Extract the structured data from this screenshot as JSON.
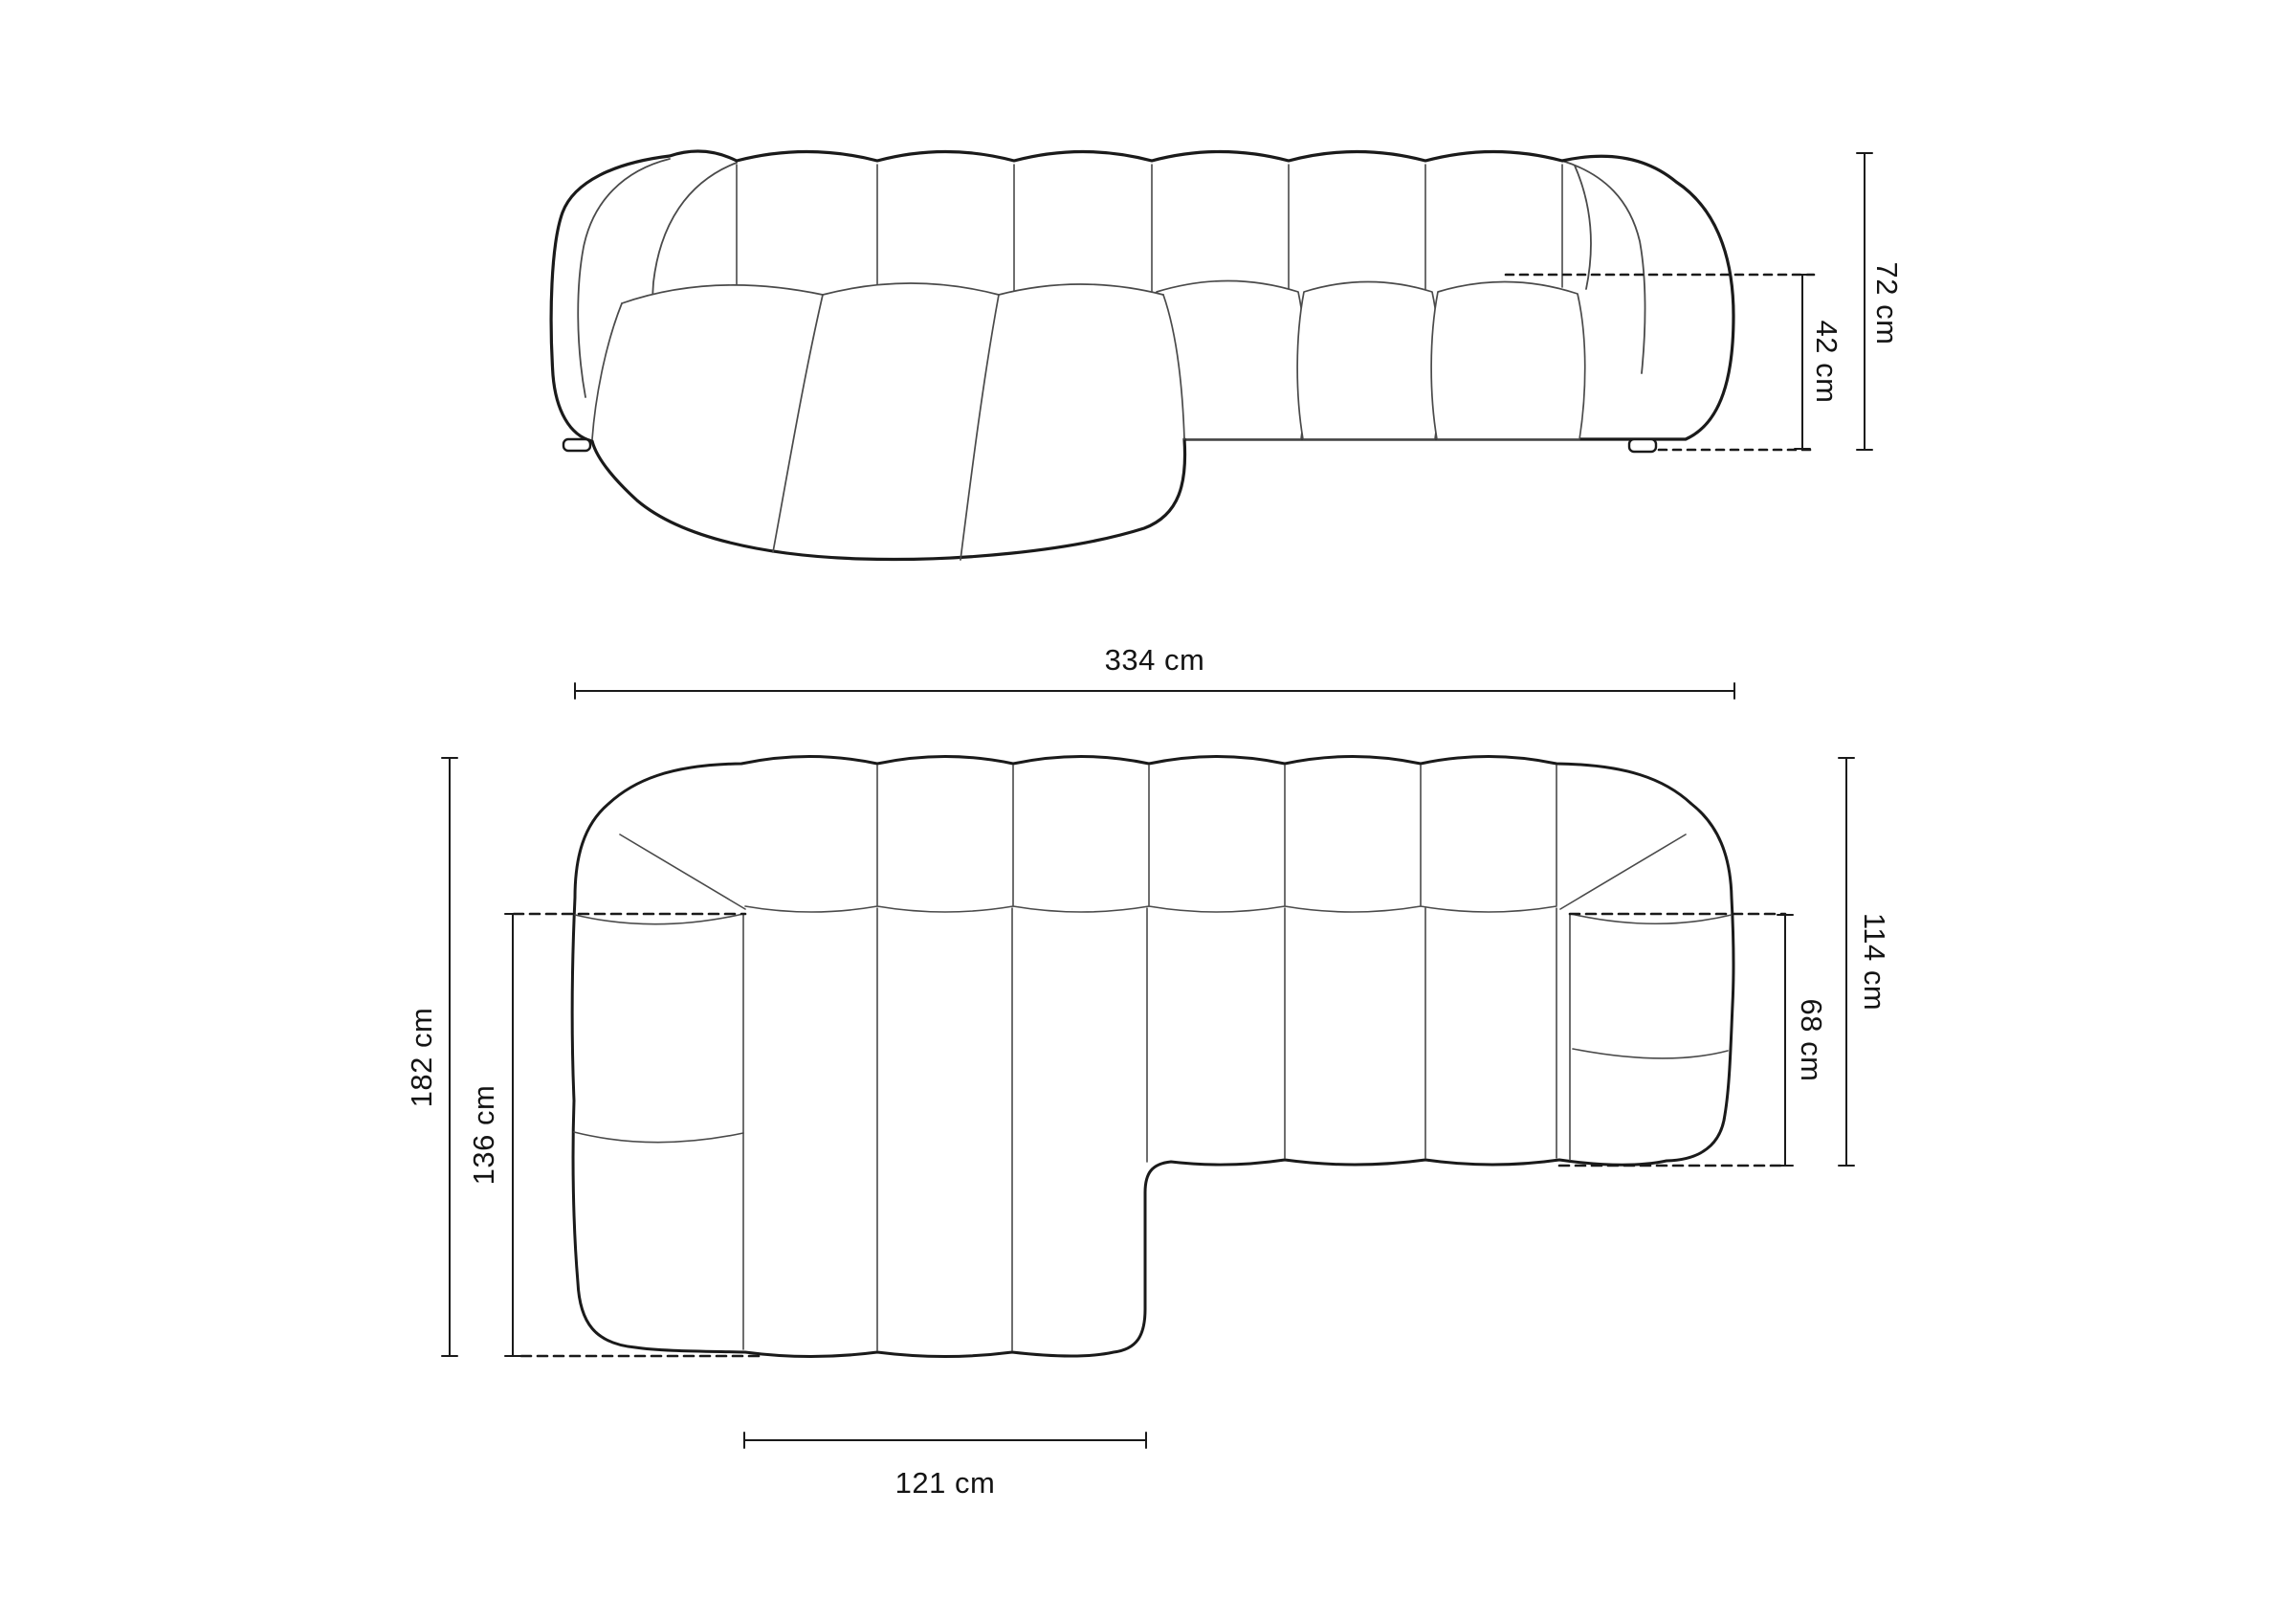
{
  "page": {
    "background": "#ffffff",
    "description": "Technical dimension diagram of a modular corner sofa with chaise longue, front elevation view above and top plan view below",
    "line_color": "#1a1a1a",
    "unit": "cm"
  },
  "views": {
    "front": {
      "name": "front-elevation-view"
    },
    "top": {
      "name": "top-plan-view"
    }
  },
  "dimensions": {
    "front": {
      "total_height": {
        "label": "72 cm",
        "value": 72
      },
      "seat_height": {
        "label": "42 cm",
        "value": 42
      }
    },
    "top": {
      "total_width": {
        "label": "334 cm",
        "value": 334
      },
      "total_depth": {
        "label": "182 cm",
        "value": 182
      },
      "chaise_depth": {
        "label": "136 cm",
        "value": 136
      },
      "chaise_width": {
        "label": "121 cm",
        "value": 121
      },
      "right_depth": {
        "label": "114 cm",
        "value": 114
      },
      "seat_depth": {
        "label": "68 cm",
        "value": 68
      }
    }
  }
}
